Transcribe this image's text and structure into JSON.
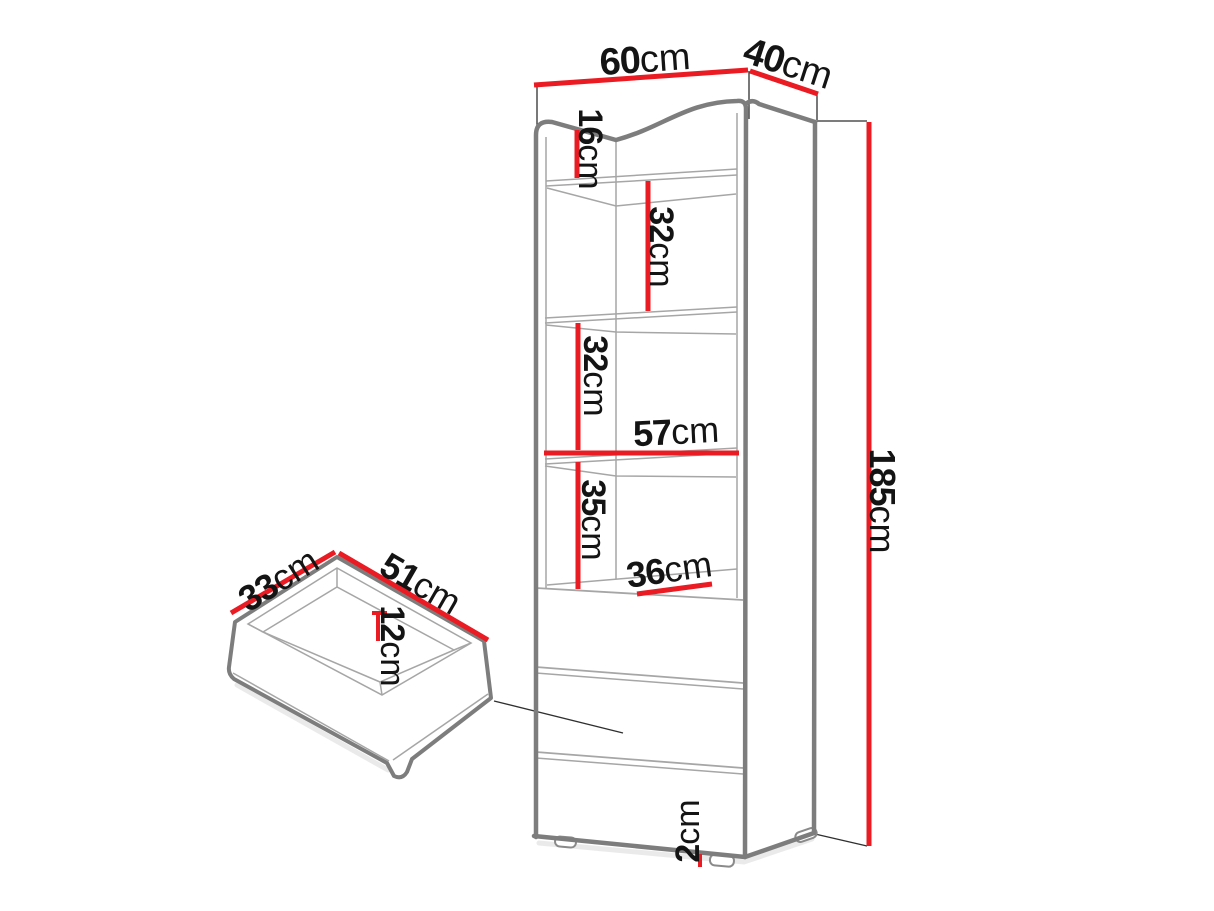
{
  "diagram": {
    "type": "furniture-dimension-diagram",
    "background_color": "#ffffff",
    "line_colors": {
      "dimension": "#ea1b22",
      "outline": "#7d7d7d",
      "detail": "#a6a6a6",
      "helper": "#2f2f2f"
    },
    "label_color": "#141414",
    "cabinet": {
      "width": {
        "value": "60",
        "unit": "cm"
      },
      "depth": {
        "value": "40",
        "unit": "cm"
      },
      "height": {
        "value": "185",
        "unit": "cm"
      },
      "top_compartment_height": {
        "value": "16",
        "unit": "cm"
      },
      "upper_shelf_spacing": {
        "value": "32",
        "unit": "cm"
      },
      "middle_shelf_spacing": {
        "value": "32",
        "unit": "cm"
      },
      "interior_width": {
        "value": "57",
        "unit": "cm"
      },
      "lower_compartment_height": {
        "value": "35",
        "unit": "cm"
      },
      "interior_depth": {
        "value": "36",
        "unit": "cm"
      },
      "foot_height": {
        "value": "2",
        "unit": "cm"
      }
    },
    "drawer": {
      "inner_depth": {
        "value": "33",
        "unit": "cm"
      },
      "inner_width": {
        "value": "51",
        "unit": "cm"
      },
      "inner_height": {
        "value": "12",
        "unit": "cm"
      }
    }
  }
}
